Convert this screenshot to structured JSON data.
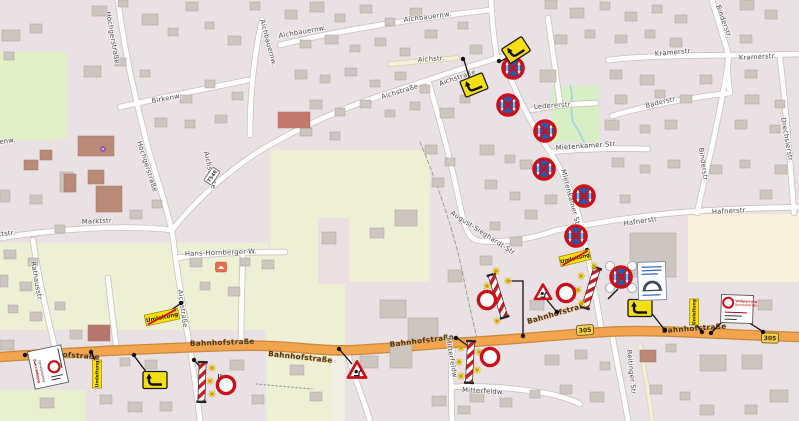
{
  "map": {
    "street_names": {
      "bahnhofstrasse": "Bahnhofstraße",
      "hoechgerstrasse": "Höchgerstraße",
      "aichstrasse": "Aichstraße",
      "aichstr_short": "Aichstr.",
      "aichbauernw": "Aichbauernw.",
      "birkenw": "Birkenw.",
      "marktstr": "Marktstr.",
      "rathausstr": "Rathausstr.",
      "hans_hornberger_w": "Hans-Hornberger-W.",
      "august_sieghardt_str": "August-Sieghardt-Str.",
      "mietenkamer_str": "Mietenkamer Str.",
      "ledererstr": "Ledererstr.",
      "kramerstr": "Kramerstr.",
      "binderstr": "Binderstr.",
      "baderstr": "Baderstr.",
      "drechslerstr": "Drechslerstr.",
      "hafnerstr": "Hafnerstr.",
      "mitterfeldw": "Mitterfeldw.",
      "reitinger_str": "Reitinger Str."
    },
    "route_refs": {
      "b305": "305",
      "ts46": "TS46"
    },
    "sign_labels": {
      "umleitung": "Umleitung",
      "closure_line1": "Vollsperrung",
      "closure_line2": "Bahnhofstraße"
    }
  }
}
